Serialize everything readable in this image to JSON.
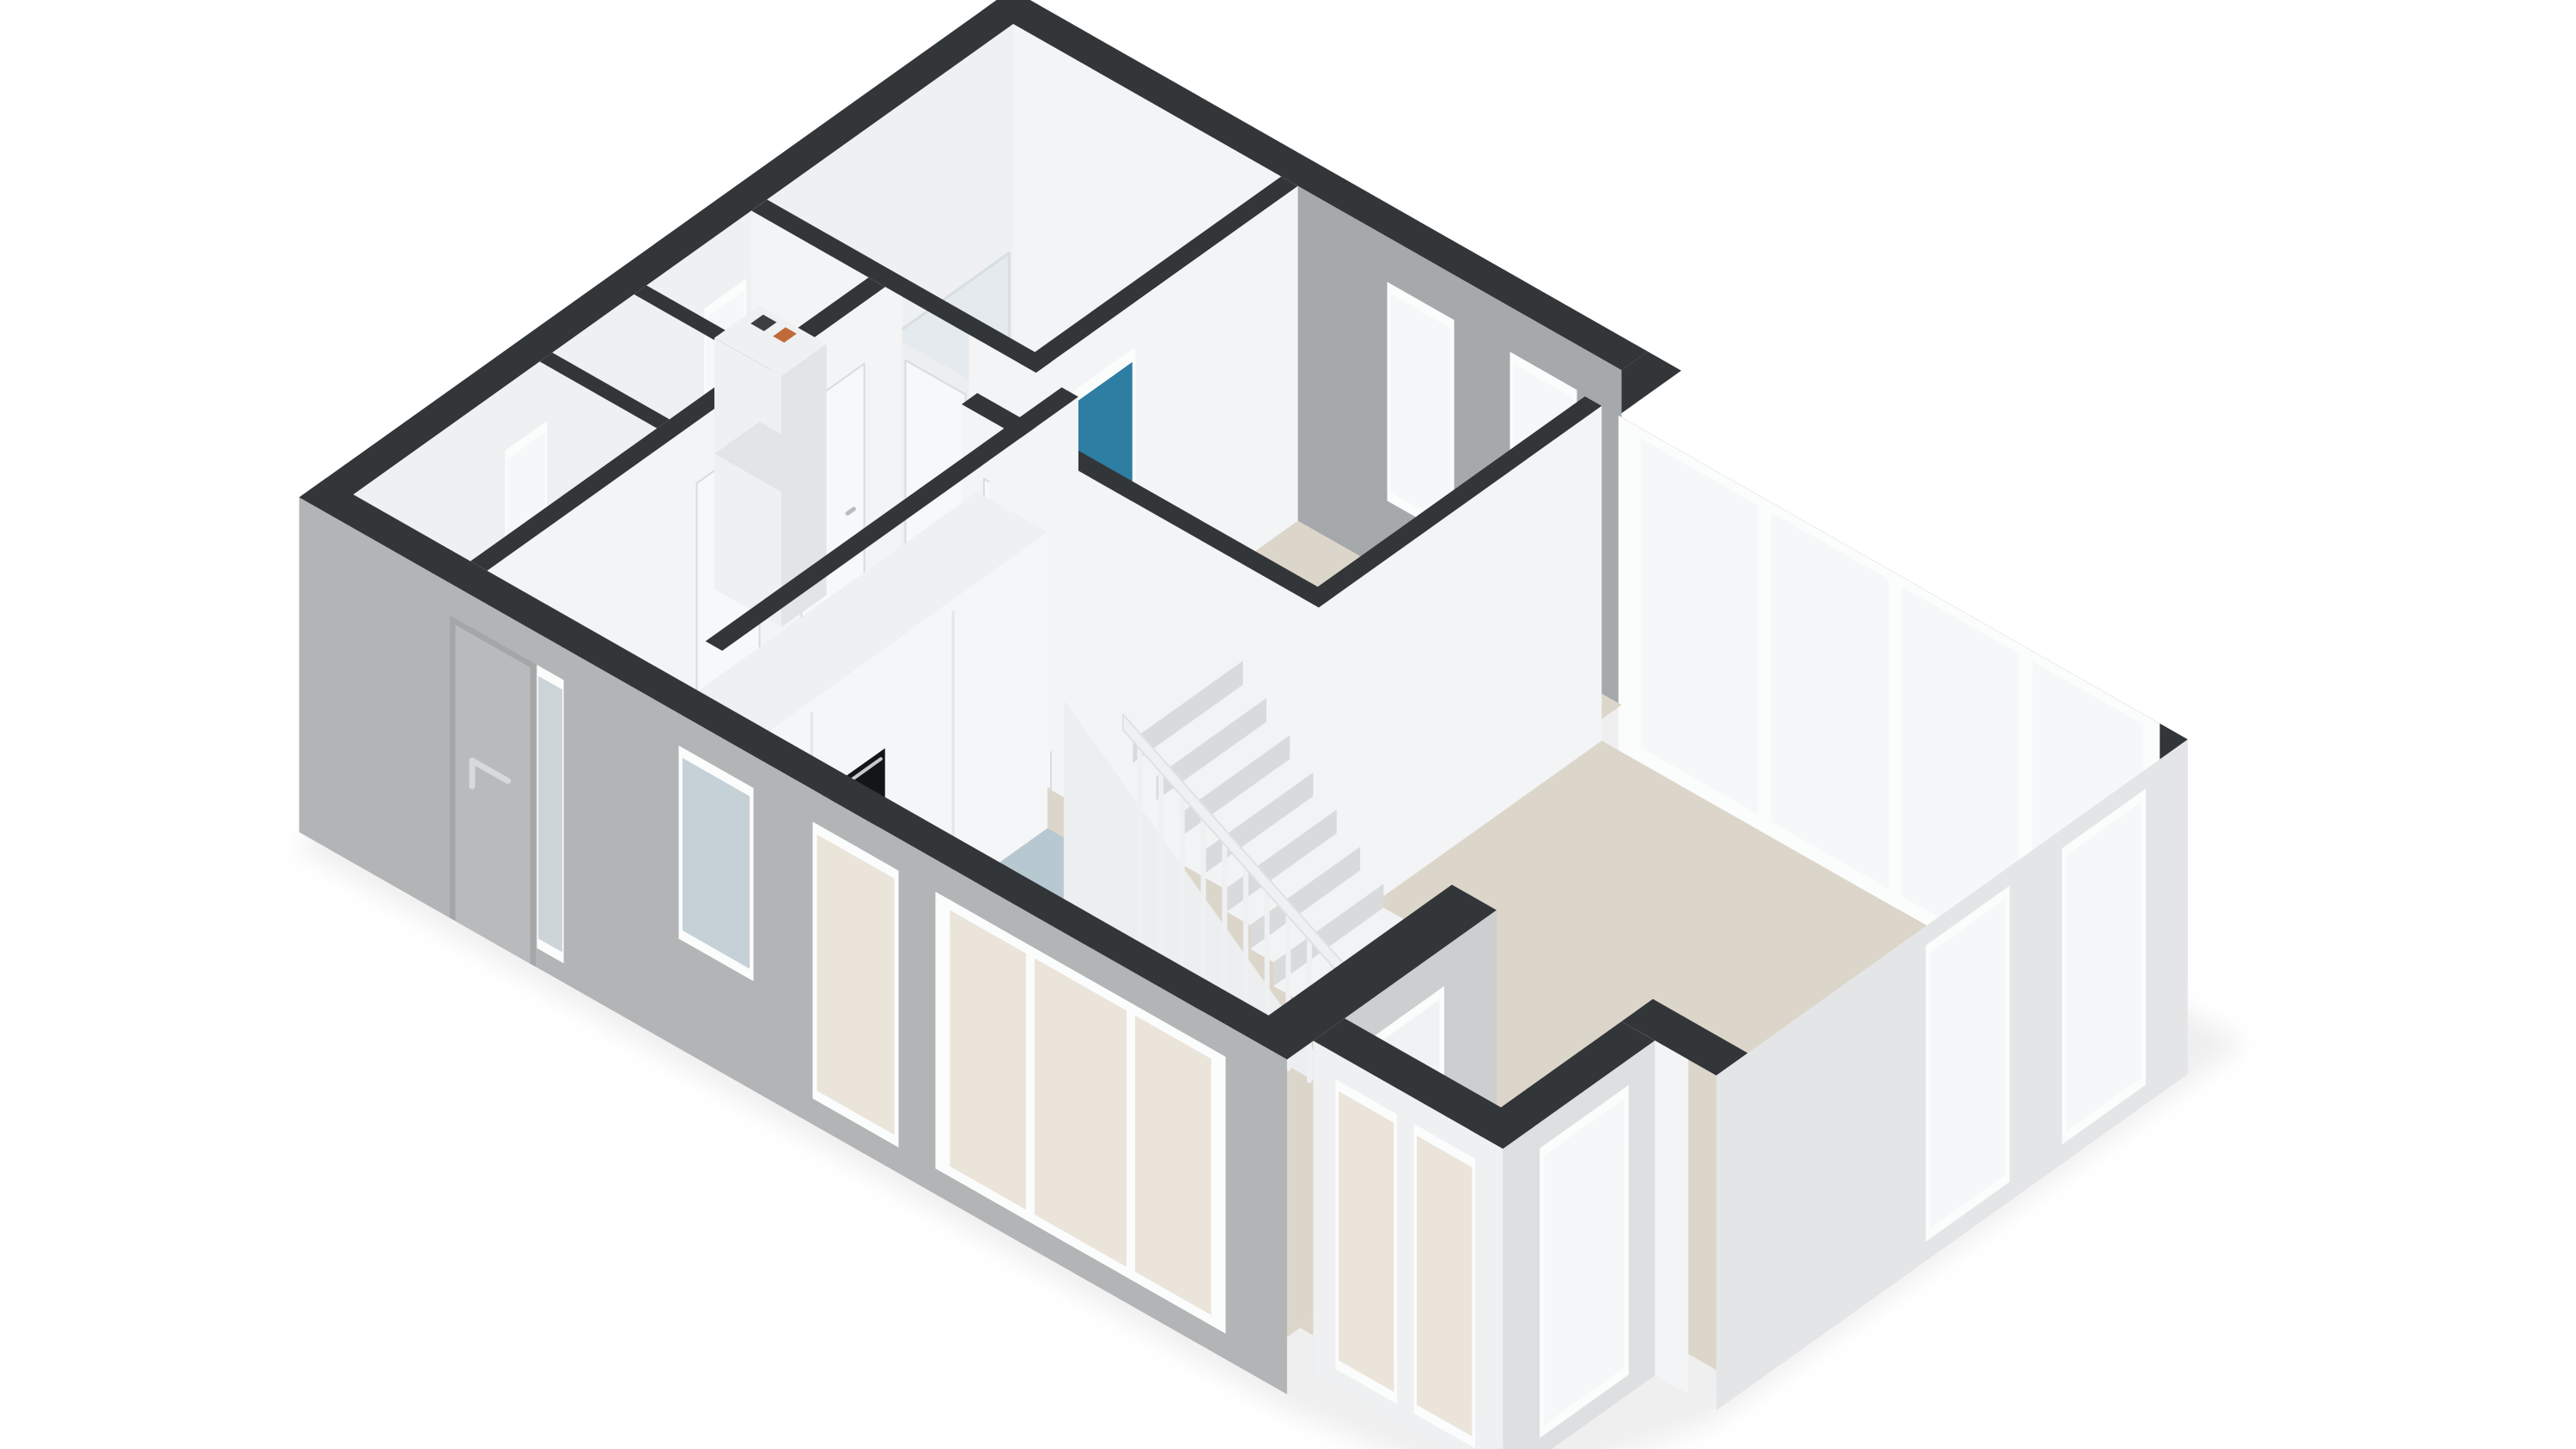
{
  "scene": {
    "type": "3d-floorplan-isometric-cutaway-rendering",
    "background": "#ffffff",
    "storey": "ground-floor",
    "style": "real-estate 3D plan, walls cut at top with dark caps, no text labels visible"
  },
  "colors": {
    "background": "#ffffff",
    "wall_cap": "#333639",
    "wall_white": "#f3f4f5",
    "wall_white_shade": "#eceeef",
    "wall_inner_nw": "#eef0f1",
    "wall_gray_inner": "#a6a9ab",
    "wall_gray_ext": "#b2b4b6",
    "wall_gray_ext_light": "#cdced0",
    "wall_light_ext": "#e4e5e7",
    "bay_ext": "#eff0f1",
    "floor_beige": "#dcd6ca",
    "floor_blue": "#b7c8d1",
    "floor_hall": "#ccd3d7",
    "floor_bath": "#e2e3e4",
    "floor_closet": "#e9eaeb",
    "frame_white": "#fbfcfc",
    "glass": "#f5f7f8",
    "glass_beige": "#eae4da",
    "glass_blue": "#c5d1d7",
    "glass_gray": "#cdd4d8",
    "door_panel": "#f7f8f9",
    "door_outline": "#d9dbdd",
    "front_door": "#b8babc",
    "handle_gray": "#d7d9da",
    "teal_door": "#2e7da2",
    "island_top": "#1a1c1e",
    "island_side": "#f2f3f4",
    "cooktop_panel": "#101214",
    "cooktop_frame": "#9da0a2",
    "burner_red": "#d5372b",
    "burner_ring": "#8c1f15",
    "burner_dot": "#401008",
    "knob_dot": "#4a4d4f",
    "oven_black": "#141517",
    "oven_handle": "#c7c9cb",
    "sink_chrome": "#c3c7c9",
    "sink_fill": "#d7dadb",
    "sink_basin": "#c2c6c8",
    "stair_tread": "#f2f3f4",
    "stair_riser": "#d8dadb",
    "stair_side": "#eceeef",
    "railing": "#eef0f1",
    "railing_edge": "#dfe1e2",
    "wood": "#c79e6b",
    "wood_dark": "#b68d5c",
    "vanity_top": "#f7f8f9",
    "tub_body": "#e4e6e7",
    "tub_top": "#f3f4f5",
    "tub_inner": "#fafbfb",
    "glass_screen": "#dbe6ea",
    "boiler_body": "#eef0f1",
    "boiler_side": "#e2e4e5",
    "boiler_dark_mark": "#3c3e40",
    "boiler_orange_mark": "#c06a3a",
    "shadow": "#e2e2e2",
    "seam": "#e3e5e6"
  },
  "inventory": {
    "rooms_visible": [
      "bathroom-top-corner",
      "meter-closet",
      "storage-closet",
      "hallway",
      "bedroom-top-middle",
      "living-room-right",
      "kitchen",
      "dining-area",
      "bay-room-bottom-right",
      "staircase-zone"
    ],
    "fixtures_visible": [
      "bathroom-vanity-with-wood-front-and-double-basin",
      "glass-shower-screen",
      "bathtub",
      "teal-blue-interior-door",
      "wall-mounted-boiler-unit",
      "white-interior-doors-with-handles",
      "tall-kitchen-cabinet-wall-with-built-in-oven",
      "black-kitchen-island",
      "ceramic-cooktop-with-4-red-burners",
      "island-sink-with-faucet",
      "staircase-with-9-steps",
      "white-stair-railing-with-balusters",
      "front-door-with-pull-handle-and-frosted-sidelight"
    ],
    "counts": {
      "cooktop_burners": 4,
      "living_room_big_window_panes": 4,
      "bedroom_windows": 2,
      "east_wall_windows": 2,
      "bay_windows": 4,
      "stair_steps": 9
    }
  }
}
